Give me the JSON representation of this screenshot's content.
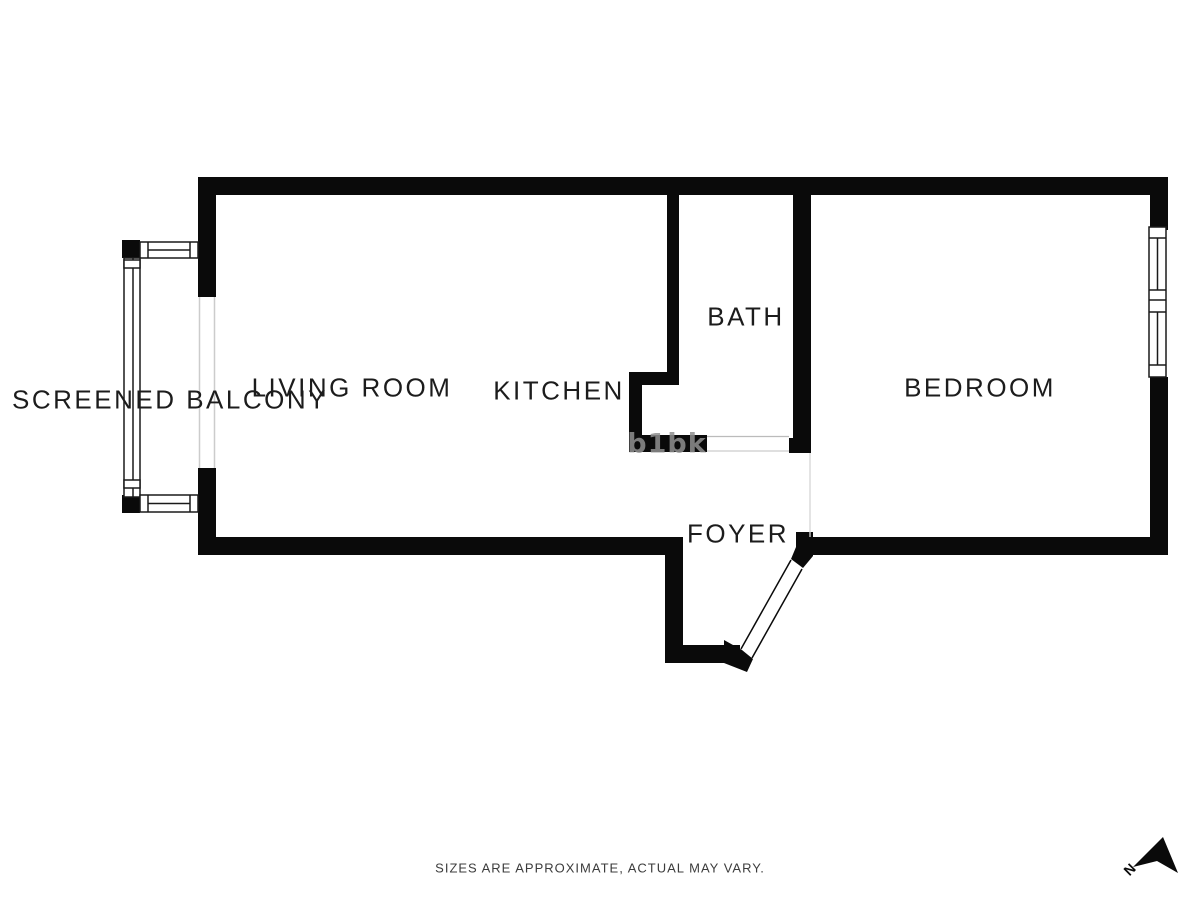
{
  "rooms": [
    {
      "id": "screened-balcony",
      "label": "SCREENED BALCONY"
    },
    {
      "id": "living-room",
      "label": "LIVING ROOM"
    },
    {
      "id": "kitchen",
      "label": "KITCHEN"
    },
    {
      "id": "bath",
      "label": "BATH"
    },
    {
      "id": "bedroom",
      "label": "BEDROOM"
    },
    {
      "id": "foyer",
      "label": "FOYER"
    }
  ],
  "footer": {
    "disclaimer": "SIZES ARE APPROXIMATE, ACTUAL MAY VARY."
  },
  "compass": {
    "label": "N"
  },
  "watermark": {
    "text": "b1bk"
  },
  "colors": {
    "background": "#ffffff",
    "wall": "#0a0a0a",
    "label": "#1c1c1c",
    "opening_line": "#cccccc",
    "watermark": "#8f8f8f"
  }
}
